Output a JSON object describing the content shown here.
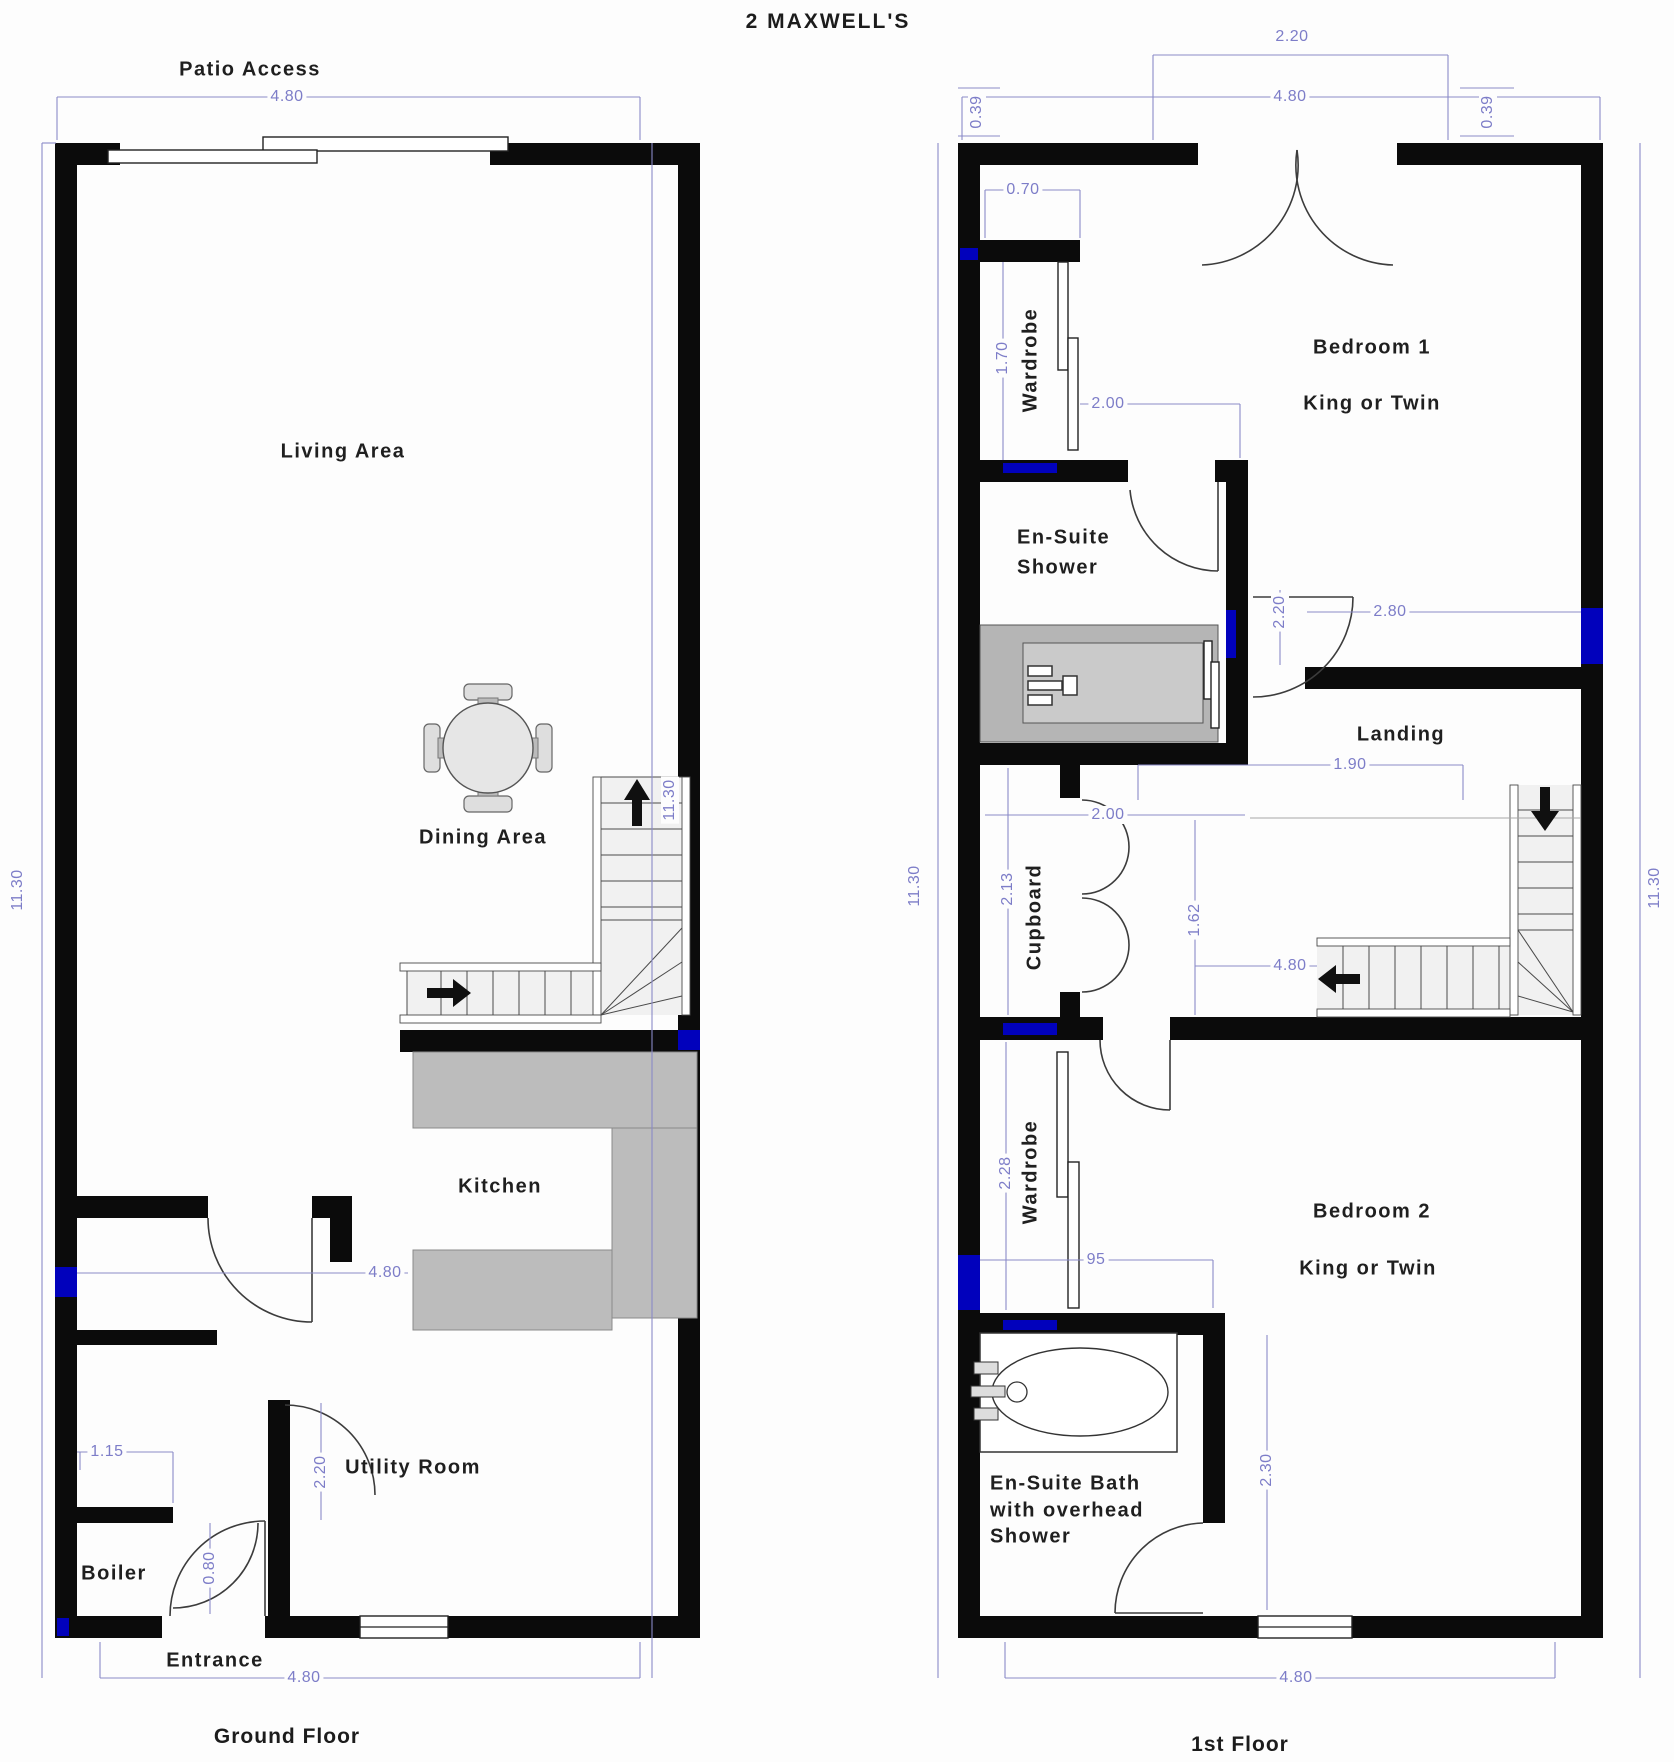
{
  "title": "2 MAXWELL'S",
  "colors": {
    "wall": "#0b0b0b",
    "dimension": "#8a8ac8",
    "accent_blue": "#0000cf",
    "counter_gray": "#bcbcbc"
  },
  "ground_floor": {
    "caption": "Ground Floor",
    "rooms": {
      "patio": "Patio Access",
      "living": "Living Area",
      "dining": "Dining Area",
      "kitchen": "Kitchen",
      "utility": "Utility Room",
      "boiler": "Boiler",
      "entrance": "Entrance"
    },
    "dims": {
      "top_width": "4.80",
      "inner_width": "4.80",
      "bottom_width": "4.80",
      "left_height": "11.30",
      "right_height": "11.30",
      "hall_width": "1.15",
      "utility_door": "2.20",
      "boiler_door": "0.80"
    }
  },
  "first_floor": {
    "caption": "1st Floor",
    "rooms": {
      "bedroom1": "Bedroom 1",
      "bedroom1_sub": "King or Twin",
      "bedroom2": "Bedroom 2",
      "bedroom2_sub": "King or Twin",
      "wardrobe1": "Wardrobe",
      "wardrobe2": "Wardrobe",
      "ensuite_shower_line1": "En-Suite",
      "ensuite_shower_line2": "Shower",
      "landing": "Landing",
      "cupboard": "Cupboard",
      "bath_line1": "En-Suite Bath",
      "bath_line2": "with overhead",
      "bath_line3": "Shower"
    },
    "dims": {
      "patio_doors": "2.20",
      "top_width": "4.80",
      "bottom_width": "4.80",
      "left_height": "11.30",
      "right_height": "11.30",
      "left_offset": "0.39",
      "right_offset": "0.39",
      "wardrobe1_depth": "0.70",
      "wardrobe1_len": "1.70",
      "shower_width": "2.00",
      "bed1_door": "2.20",
      "bed1_width": "2.80",
      "landing_width": "1.90",
      "cupboard_door": "2.00",
      "cupboard_len": "2.13",
      "stair_well": "1.62",
      "stairs_len": "4.80",
      "wardrobe2_len": "2.28",
      "wardrobe2_alcove": "95",
      "bath_len": "2.30"
    }
  }
}
